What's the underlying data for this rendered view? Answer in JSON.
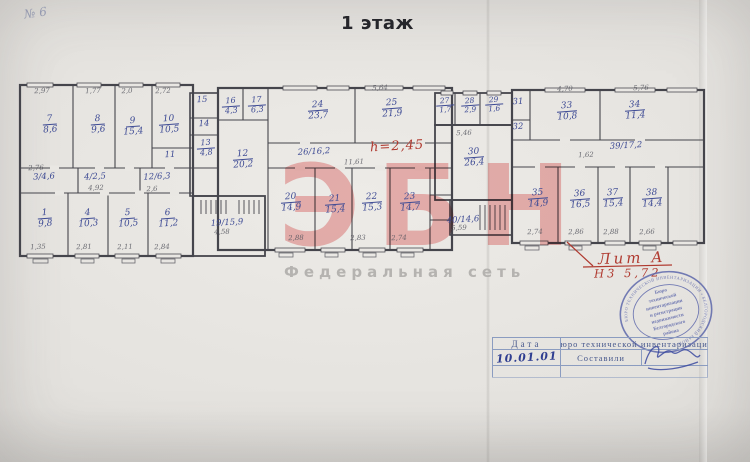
{
  "title": "1 этаж",
  "corner_mark": "№ 6",
  "watermark": {
    "letters": "ЭБН",
    "subtitle": "Федеральная сеть"
  },
  "annotations": {
    "height_note": "h=2,45",
    "lit": "Лит А",
    "lit_height": "Н3 5,72"
  },
  "plan": {
    "room_labels": [
      {
        "num": "7",
        "area": "8,6"
      },
      {
        "num": "8",
        "area": "9,6"
      },
      {
        "num": "9",
        "area": "15,4"
      },
      {
        "num": "10",
        "area": "10,5"
      },
      {
        "num": "1",
        "area": "9,8"
      },
      {
        "num": "4",
        "area": "10,3"
      },
      {
        "num": "5",
        "area": "10,5"
      },
      {
        "num": "6",
        "area": "11,2"
      },
      {
        "num": "16",
        "area": "4,3"
      },
      {
        "num": "17",
        "area": "6,3"
      },
      {
        "num": "13",
        "area": "4,8"
      },
      {
        "num": "12",
        "area": "20,2"
      },
      {
        "num": "24",
        "area": "23,7"
      },
      {
        "num": "25",
        "area": "21,9"
      },
      {
        "num": "20",
        "area": "14,9"
      },
      {
        "num": "21",
        "area": "15,4"
      },
      {
        "num": "22",
        "area": "15,3"
      },
      {
        "num": "23",
        "area": "14,7"
      },
      {
        "num": "27",
        "area": "1,7"
      },
      {
        "num": "28",
        "area": "2,9"
      },
      {
        "num": "29",
        "area": "1,6"
      },
      {
        "num": "30",
        "area": "26,4"
      },
      {
        "num": "33",
        "area": "10,8"
      },
      {
        "num": "34",
        "area": "11,4"
      },
      {
        "num": "35",
        "area": "14,9"
      },
      {
        "num": "36",
        "area": "16,5"
      },
      {
        "num": "37",
        "area": "15,4"
      },
      {
        "num": "38",
        "area": "14,4"
      }
    ],
    "inline_labels": [
      "3/4,6",
      "4/2,5",
      "12/6,3",
      "19/15,9",
      "26/16,2",
      "40/14,6",
      "39/17,2",
      "11",
      "14",
      "15",
      "31",
      "32"
    ],
    "dims": [
      "2,97",
      "1,77",
      "2,0",
      "2,72",
      "2,76",
      "4,92",
      "2,6",
      "1,35",
      "2,81",
      "2,11",
      "2,84",
      "5,64",
      "11,61",
      "4,58",
      "5,46",
      "2,88",
      "2,83",
      "2,74",
      "4,70",
      "5,76",
      "1,62",
      "5,59",
      "2,74",
      "2,86",
      "2,88",
      "2,66"
    ]
  },
  "stamp": {
    "ring_text": "БЮРО ТЕХНИЧЕСКОЙ ИНВЕНТАРИЗАЦИИ • БЕЛГОРОДСКИЙ РАЙОН •",
    "center_lines": [
      "Бюро",
      "технической",
      "инвентаризации",
      "и регистрации",
      "недвижимости",
      "Белгородского",
      "района"
    ]
  },
  "table": {
    "date_label": "Дата",
    "bureau_label": "Бюро технической инвентаризации",
    "date_value": "10.01.01",
    "compiled_label": "Составили"
  }
}
